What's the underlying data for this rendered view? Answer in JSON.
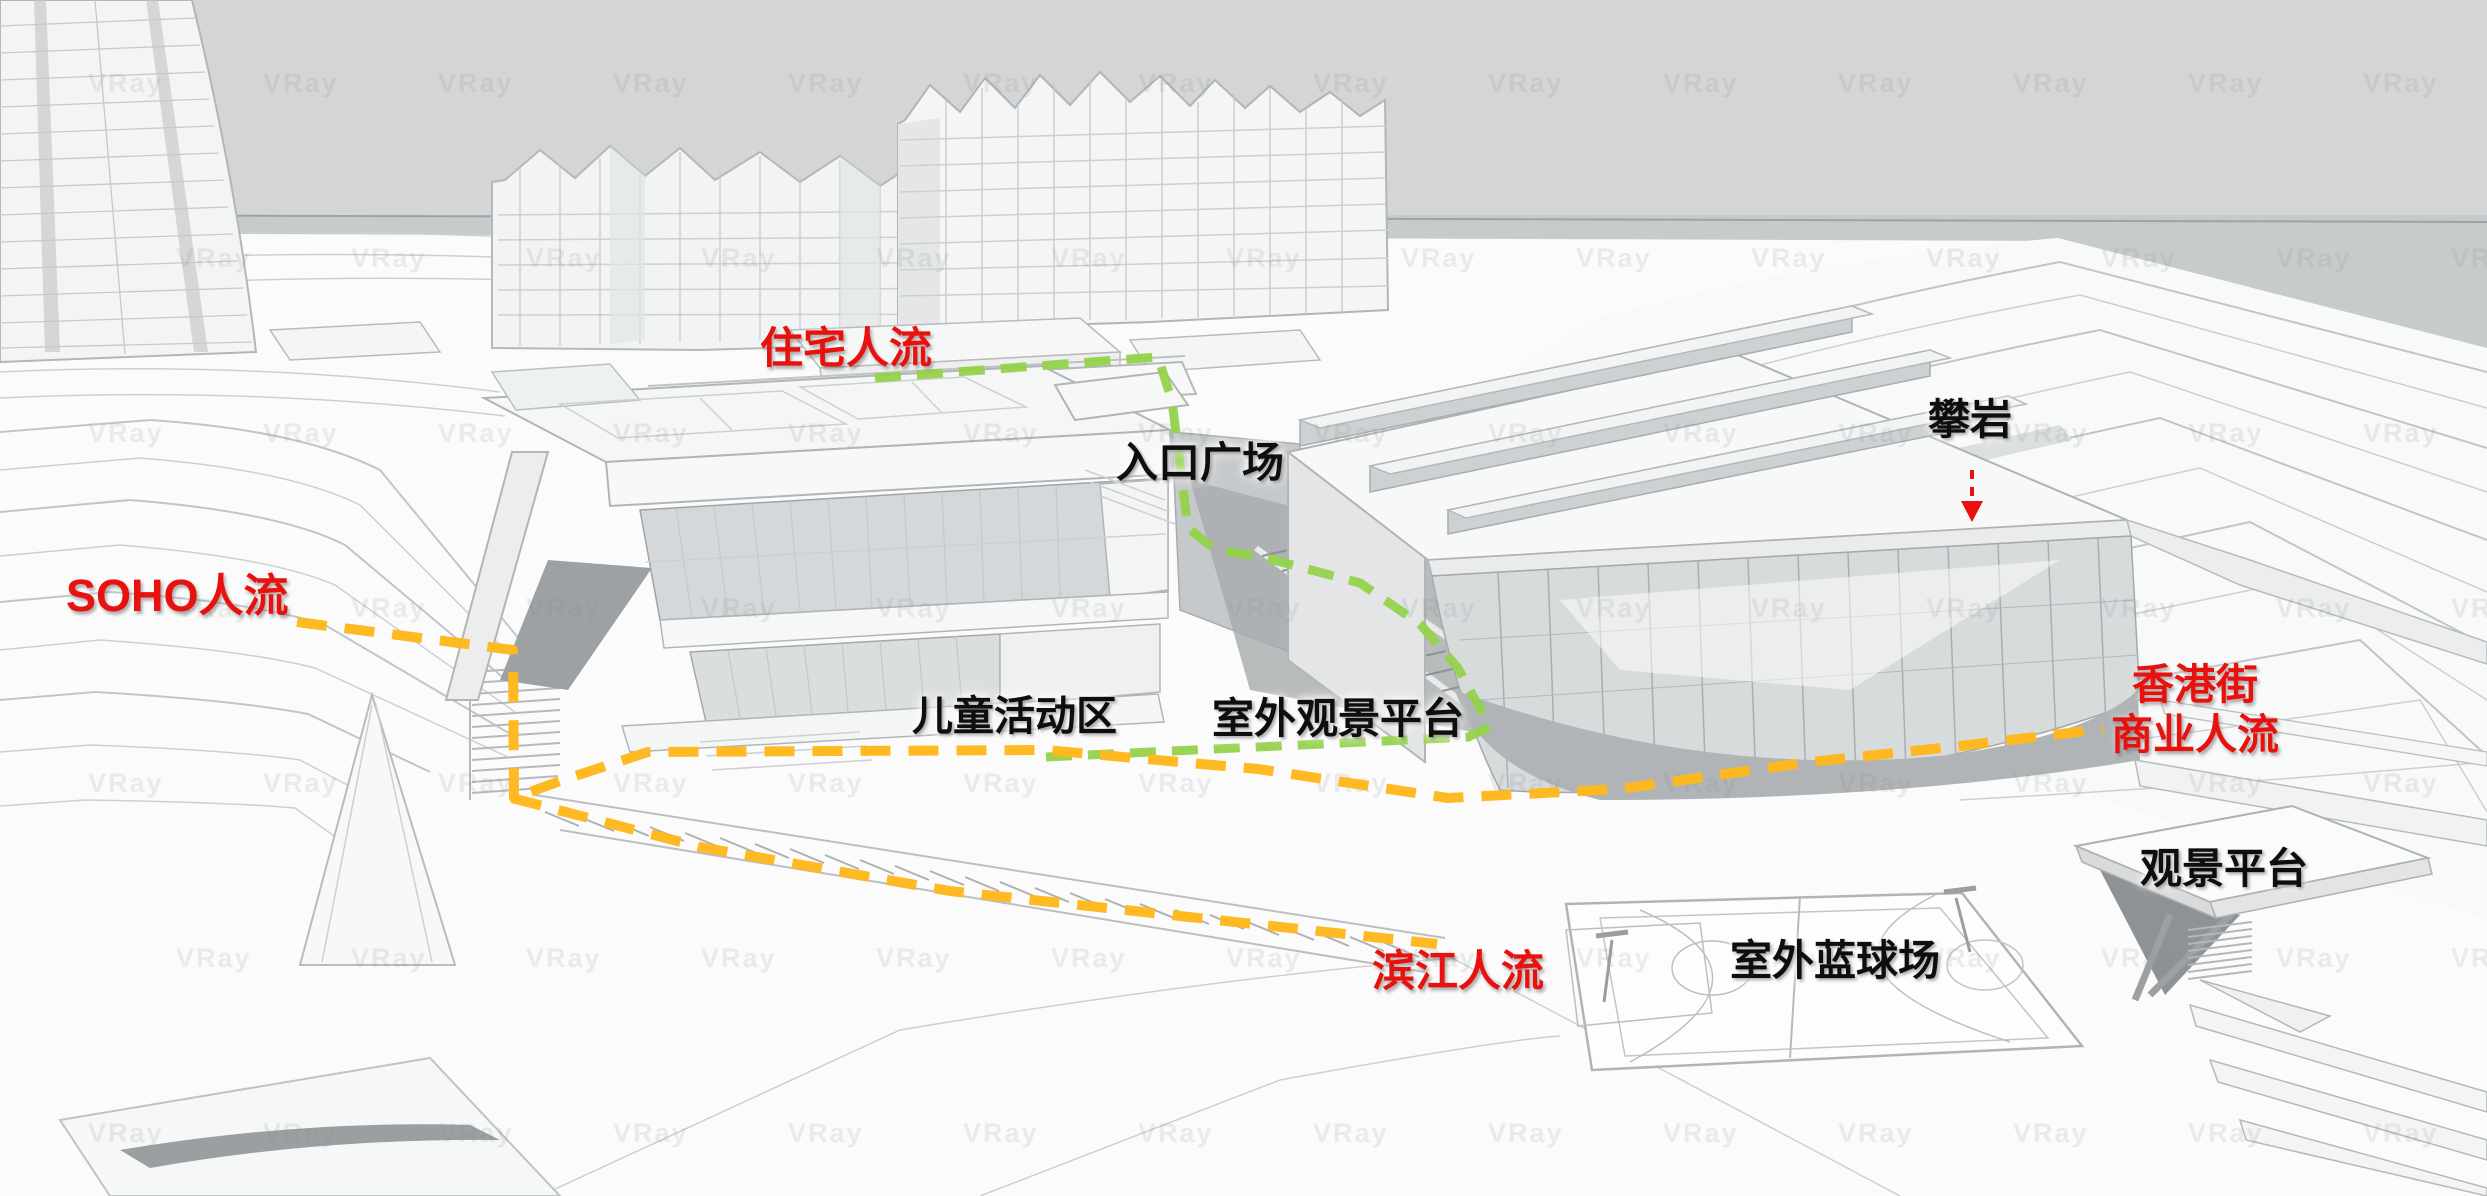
{
  "scene": {
    "watermark": "VRay",
    "colors": {
      "sky": "#d3d5d6",
      "water": "#c8cbcc",
      "residential_flow": "#93d24b",
      "commercial_flow": "#ffb81c",
      "accent_red": "#e8110d",
      "label_black": "#0e0e0e"
    }
  },
  "labels": {
    "residential_flow": "住宅人流",
    "entrance_plaza": "入口广场",
    "rock_climbing": "攀岩",
    "soho_flow": "SOHO人流",
    "children_activity_area": "儿童活动区",
    "outdoor_viewing_platform": "室外观景平台",
    "hk_street_commercial_flow_line1": "香港街",
    "hk_street_commercial_flow_line2": "商业人流",
    "viewing_platform": "观景平台",
    "riverside_flow": "滨江人流",
    "outdoor_basketball_court": "室外蓝球场"
  }
}
